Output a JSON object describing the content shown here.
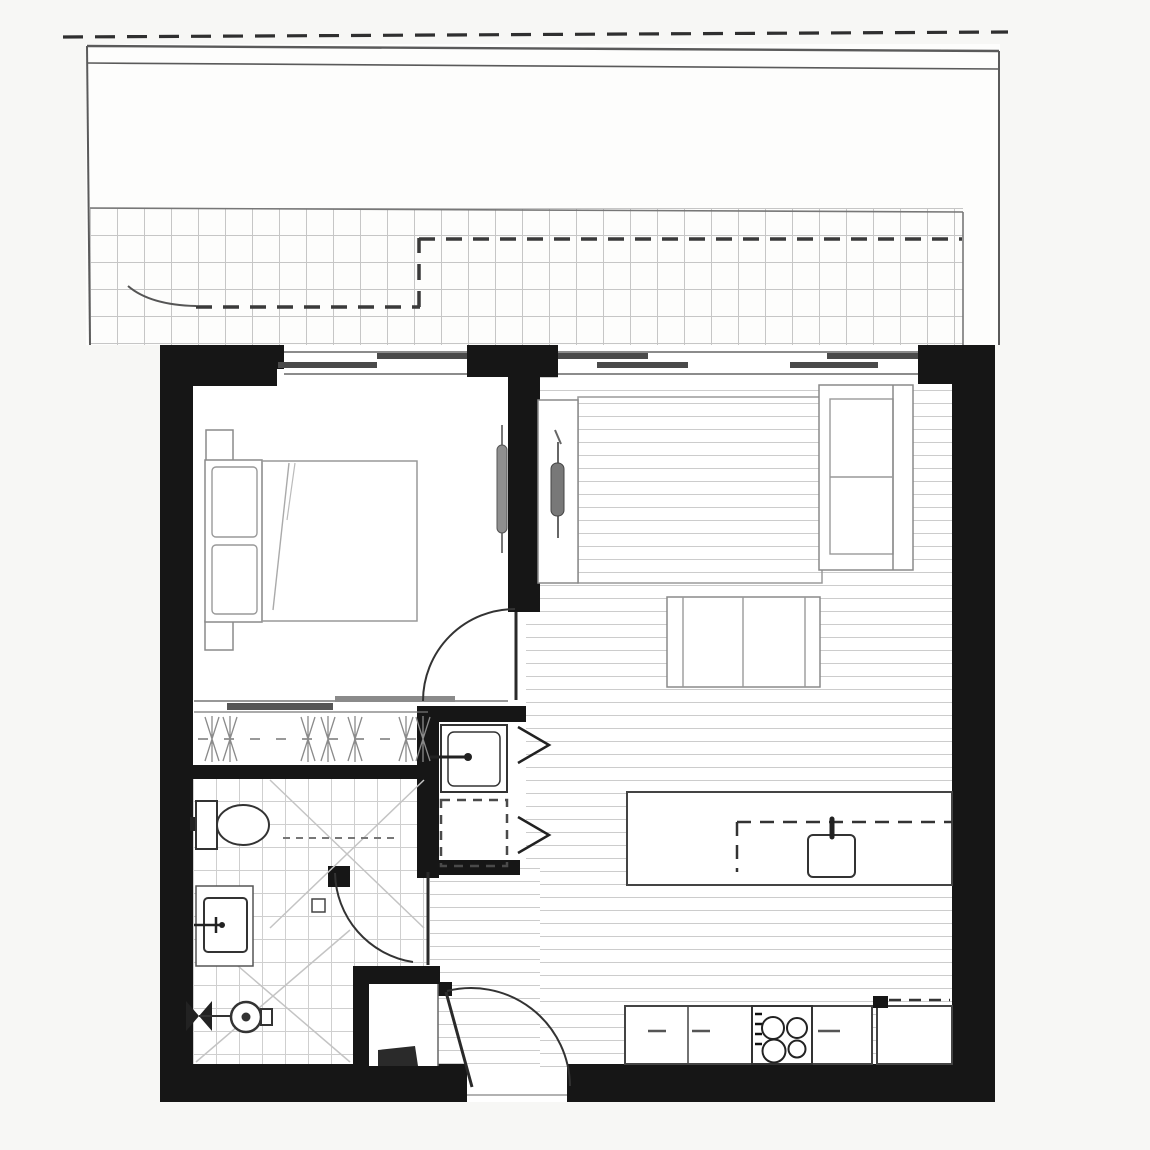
{
  "title": "apartment-floor-plan",
  "rooms": {
    "balcony": "Balcony terrace",
    "bedroom": "Bedroom",
    "living": "Living room",
    "kitchen": "Kitchen",
    "bathroom": "Bathroom",
    "laundry": "Laundry cupboard",
    "entry": "Entry",
    "wardrobe": "Wardrobe"
  },
  "fixtures": {
    "bed": "double-bed",
    "tv": "wall-mounted-tv",
    "sofa": "two-seat-sofa",
    "table": "coffee-table",
    "rug": "rug",
    "island": "kitchen-island-with-sink",
    "cooktop": "four-burner-cooktop",
    "fridge": "fridge-space",
    "toilet": "toilet",
    "vanity": "vanity-basin",
    "shower": "shower-rose-and-drain",
    "trough": "laundry-trough",
    "washer": "washing-machine-space"
  },
  "colors": {
    "wall": "#161616",
    "door_line": "#2a2a2a",
    "fixture_line": "#333333",
    "furniture_line": "#8a8a8a",
    "tile_line": "#c6c6c6",
    "plank_line": "#cccccc",
    "window_panel": "#4a4a4a",
    "background": "#f7f7f5",
    "paper": "#ffffff"
  }
}
